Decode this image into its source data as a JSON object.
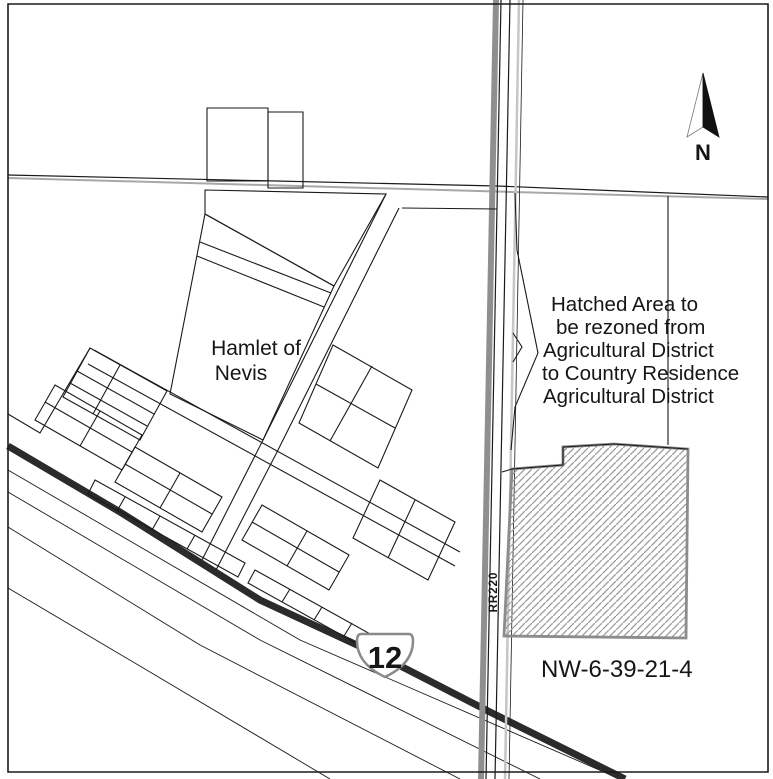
{
  "annotations": {
    "hamlet_label_line1": "Hamlet of",
    "hamlet_label_line2": "Nevis",
    "rezone_note_line1": "Hatched Area to",
    "rezone_note_line2": "be rezoned from",
    "rezone_note_line3": "Agricultural District",
    "rezone_note_line4": "to Country Residence",
    "rezone_note_line5": "Agricultural District",
    "parcel_id": "NW-6-39-21-4",
    "road_label": "RR220",
    "highway_number": "12",
    "north_indicator": "N"
  },
  "colors": {
    "paper": "#ffffff",
    "ink": "#1a1a1a",
    "highway": "#2b2b2b",
    "road_casing_gray": "#8f8f8f",
    "road_light_gray": "#c6c6c6",
    "hatch_outline_gray": "#8c8c8c",
    "hatch_line_gray": "#9b9b9b",
    "section_line_gray": "#a8a8a8"
  },
  "map": {
    "width": 773,
    "height": 779,
    "layers": [
      {
        "name": "section-line-gray",
        "type": "polyline",
        "pts": "8,178 768,199",
        "stroke": "#a8a8a8",
        "w": 2
      },
      {
        "name": "section-line",
        "type": "polyline",
        "pts": "8,175 497,186 768,197",
        "stroke": "#1a1a1a",
        "w": 1.2
      },
      {
        "name": "rail-allowance-line-1",
        "type": "polyline",
        "pts": "8,470 300,640 620,779",
        "stroke": "#1a1a1a",
        "w": 0.9
      },
      {
        "name": "rail-allowance-line-2",
        "type": "polyline",
        "pts": "8,492 260,640 540,779",
        "stroke": "#1a1a1a",
        "w": 0.9
      },
      {
        "name": "rail-allowance-line-3",
        "type": "polyline",
        "pts": "8,527 200,645 460,779",
        "stroke": "#1a1a1a",
        "w": 0.9
      },
      {
        "name": "rail-allowance-line-4",
        "type": "polyline",
        "pts": "8,588 150,672 330,779",
        "stroke": "#1a1a1a",
        "w": 0.9
      },
      {
        "name": "highway-12-line",
        "type": "polyline",
        "pts": "8,446 120,512 260,600 385,658 490,712 625,779",
        "stroke": "#2b2b2b",
        "w": 7
      },
      {
        "name": "rr220-casing-gray",
        "type": "polyline",
        "pts": "496,0 481,779",
        "stroke": "#8f8f8f",
        "w": 6
      },
      {
        "name": "rr220-edge-west",
        "type": "polyline",
        "pts": "501,0 486,779",
        "stroke": "#1a1a1a",
        "w": 1.2
      },
      {
        "name": "rr220-edge-east",
        "type": "polyline",
        "pts": "510,0 495,779",
        "stroke": "#1a1a1a",
        "w": 1.2
      },
      {
        "name": "rr220-shoulder-light",
        "type": "polyline",
        "pts": "519,0 505,779",
        "stroke": "#c6c6c6",
        "w": 2.5
      },
      {
        "name": "rr220-fence-line",
        "type": "polyline",
        "pts": "523,0 509,779",
        "stroke": "#1a1a1a",
        "w": 0.8
      },
      {
        "name": "top-building-left",
        "type": "polygon",
        "pts": "207,108 268,108 268,181 207,181"
      },
      {
        "name": "top-building-right",
        "type": "polygon",
        "pts": "268,112 303,112 303,188 268,188"
      },
      {
        "name": "north-strip-parcel",
        "type": "polygon",
        "pts": "205,190 386,194 334,286 205,214"
      },
      {
        "name": "hamlet-text-parcel",
        "type": "polygon",
        "pts": "205,214 334,286 263,440 170,394"
      },
      {
        "name": "hamlet-text-parcel-lot-line-1",
        "type": "polyline",
        "pts": "200,242 331,293"
      },
      {
        "name": "hamlet-text-parcel-lot-line-2",
        "type": "polyline",
        "pts": "197,256 324,307"
      },
      {
        "name": "hamlet-nw-boundary",
        "type": "polyline",
        "pts": "8,414 40,433 90,348"
      },
      {
        "name": "block-w1",
        "type": "polygon",
        "pts": "90,348 167,391 140,440 63,397"
      },
      {
        "name": "block-w1-lot-line-1",
        "type": "polyline",
        "pts": "77,371 154,414"
      },
      {
        "name": "block-w1-lot-line-2",
        "type": "polyline",
        "pts": "70,383 147,426"
      },
      {
        "name": "block-w1-lot-line-3",
        "type": "polyline",
        "pts": "120,365 93,414"
      },
      {
        "name": "main-street-north-edge",
        "type": "polyline",
        "pts": "94,350 460,552"
      },
      {
        "name": "main-street-south-edge",
        "type": "polyline",
        "pts": "88,364 455,566"
      },
      {
        "name": "cross-street-west-edge",
        "type": "polyline",
        "pts": "386,194 263,440"
      },
      {
        "name": "cross-street-east-edge",
        "type": "polyline",
        "pts": "399,208 276,454"
      },
      {
        "name": "cross-street-ext-west-edge",
        "type": "polyline",
        "pts": "263,440 202,560"
      },
      {
        "name": "cross-street-ext-east-edge",
        "type": "polyline",
        "pts": "276,454 216,570"
      },
      {
        "name": "parcel-line-to-road",
        "type": "polyline",
        "pts": "402,208 497,209"
      },
      {
        "name": "block-m1",
        "type": "polygon",
        "pts": "55,385 142,435 122,470 35,420"
      },
      {
        "name": "block-m1-lot-line-1",
        "type": "polyline",
        "pts": "100,411 80,446"
      },
      {
        "name": "block-m1-lot-line-2",
        "type": "polyline",
        "pts": "45,402 132,452"
      },
      {
        "name": "block-m2",
        "type": "polygon",
        "pts": "135,447 222,497 202,532 115,482"
      },
      {
        "name": "block-m2-lot-line-1",
        "type": "polyline",
        "pts": "180,473 160,508"
      },
      {
        "name": "block-m2-lot-line-2",
        "type": "polyline",
        "pts": "125,464 212,514"
      },
      {
        "name": "block-m3",
        "type": "polygon",
        "pts": "262,505 349,555 329,590 242,540"
      },
      {
        "name": "block-m3-lot-line-1",
        "type": "polyline",
        "pts": "307,531 287,566"
      },
      {
        "name": "block-m3-lot-line-2",
        "type": "polyline",
        "pts": "252,522 339,572"
      },
      {
        "name": "block-east-parallelogram",
        "type": "polygon",
        "pts": "333,345 412,390 378,468 299,423"
      },
      {
        "name": "block-east-lot-line-1",
        "type": "polyline",
        "pts": "316,384 395,428"
      },
      {
        "name": "block-east-lot-line-2",
        "type": "polyline",
        "pts": "372,366 330,441"
      },
      {
        "name": "block-e2",
        "type": "polygon",
        "pts": "380,480 455,522 428,580 353,538"
      },
      {
        "name": "block-e2-lot-line",
        "type": "polyline",
        "pts": "415,500 388,558"
      },
      {
        "name": "block-r3a",
        "type": "polygon",
        "pts": "95,480 245,563 238,577 88,494"
      },
      {
        "name": "block-r3a-lot-line-1",
        "type": "polyline",
        "pts": "125,497 117,511"
      },
      {
        "name": "block-r3a-lot-line-2",
        "type": "polyline",
        "pts": "160,516 152,530"
      },
      {
        "name": "block-r3a-lot-line-3",
        "type": "polyline",
        "pts": "195,535 187,549"
      },
      {
        "name": "block-r3b",
        "type": "polygon",
        "pts": "255,570 390,645 383,658 248,583"
      },
      {
        "name": "block-r3b-lot-line-1",
        "type": "polyline",
        "pts": "290,589 282,602"
      },
      {
        "name": "block-r3b-lot-line-2",
        "type": "polyline",
        "pts": "322,607 314,620"
      },
      {
        "name": "block-r3b-lot-line-3",
        "type": "polyline",
        "pts": "352,623 344,636"
      },
      {
        "name": "road-east-boundary-jog",
        "type": "polyline",
        "pts": "515,193 517,250 538,353 515,407 511,450"
      },
      {
        "name": "road-east-boundary-notch",
        "type": "polyline",
        "pts": "513,333 522,347 513,362"
      },
      {
        "name": "quarter-section-line-east",
        "type": "polyline",
        "pts": "668,196 668,445"
      },
      {
        "name": "rezone-hatch-area",
        "type": "polygon",
        "pts": "512,469 563,465 563,447 614,444 688,449 686,638 504,636",
        "stroke": "#8c8c8c",
        "w": 2.8,
        "fill": "hatch"
      },
      {
        "name": "rezone-parcel-north-boundary",
        "type": "polyline",
        "pts": "502,472 512,469 563,465 563,447 614,444 688,449",
        "stroke": "#1a1a1a",
        "w": 1.1
      },
      {
        "name": "map-border",
        "type": "polygon",
        "pts": "8,4 768,4 768,772 8,772",
        "stroke": "#1a1a1a",
        "w": 1.6
      },
      {
        "name": "highway-shield",
        "type": "path",
        "d": "M361,634 H409 Q413,634 413,641 C413,656 404,668 385,677 C366,668 357,656 357,641 Q357,634 361,634 Z",
        "stroke": "#8a8a8a",
        "w": 2.5,
        "fill": "#ffffff"
      },
      {
        "name": "north-arrow-left-half",
        "type": "polygon",
        "pts": "703,73 687,137 703,127",
        "stroke": "#777777",
        "w": 0.8,
        "fill": "#ffffff"
      },
      {
        "name": "north-arrow-right-half",
        "type": "polygon",
        "pts": "703,73 719,137 703,127",
        "stroke": "#111111",
        "w": 0.8,
        "fill": "#111111"
      }
    ],
    "texts": [
      {
        "name": "hamlet-label-line1",
        "bind": "annotations.hamlet_label_line1",
        "x": 256,
        "y": 355,
        "size": 21,
        "weight": 500,
        "anchor": "middle"
      },
      {
        "name": "hamlet-label-line2",
        "bind": "annotations.hamlet_label_line2",
        "x": 241,
        "y": 380,
        "size": 21,
        "weight": 500,
        "anchor": "middle"
      },
      {
        "name": "rezone-note-line1",
        "bind": "annotations.rezone_note_line1",
        "x": 551,
        "y": 311,
        "size": 20.5,
        "weight": 500,
        "anchor": "start"
      },
      {
        "name": "rezone-note-line2",
        "bind": "annotations.rezone_note_line2",
        "x": 556,
        "y": 334,
        "size": 20.5,
        "weight": 500,
        "anchor": "start"
      },
      {
        "name": "rezone-note-line3",
        "bind": "annotations.rezone_note_line3",
        "x": 543,
        "y": 357,
        "size": 20.5,
        "weight": 500,
        "anchor": "start"
      },
      {
        "name": "rezone-note-line4",
        "bind": "annotations.rezone_note_line4",
        "x": 542,
        "y": 380,
        "size": 20.5,
        "weight": 500,
        "anchor": "start"
      },
      {
        "name": "rezone-note-line5",
        "bind": "annotations.rezone_note_line5",
        "x": 543,
        "y": 403,
        "size": 20.5,
        "weight": 500,
        "anchor": "start"
      },
      {
        "name": "parcel-id-label",
        "bind": "annotations.parcel_id",
        "x": 541,
        "y": 677,
        "size": 24,
        "weight": 500,
        "anchor": "start"
      },
      {
        "name": "rr220-road-label",
        "bind": "annotations.road_label",
        "x": 497,
        "y": 592,
        "size": 11.5,
        "weight": 700,
        "anchor": "middle",
        "rotate": -90,
        "ls": 1
      },
      {
        "name": "highway-shield-number",
        "bind": "annotations.highway_number",
        "x": 385,
        "y": 668,
        "size": 31,
        "weight": 600,
        "anchor": "middle"
      },
      {
        "name": "north-arrow-label",
        "bind": "annotations.north_indicator",
        "x": 703,
        "y": 160,
        "size": 22,
        "weight": 700,
        "anchor": "middle"
      }
    ]
  }
}
